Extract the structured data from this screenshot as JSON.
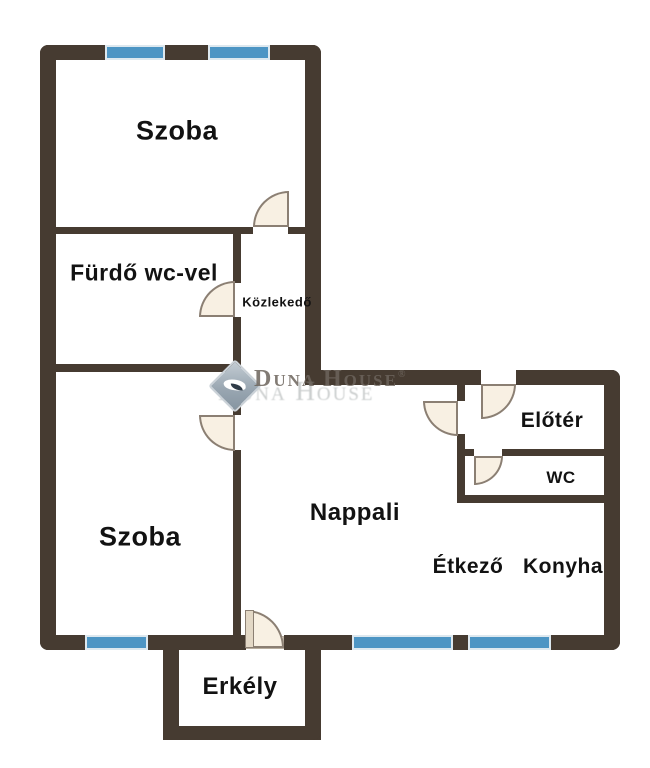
{
  "colors": {
    "wall": "#463B31",
    "window_glass": "#4D95C4",
    "window_frame": "#DDE8EF",
    "door_fill": "#F8F0E3",
    "door_stroke": "#8B7F73",
    "label_text": "#121212",
    "watermark_text": "#6C645C",
    "watermark_logo": "#9AA7B2"
  },
  "rooms": [
    {
      "id": "szoba-felso",
      "label": "Szoba"
    },
    {
      "id": "furdo",
      "label": "Fürdő wc-vel"
    },
    {
      "id": "kozlekedo",
      "label": "Közlekedő"
    },
    {
      "id": "szoba-also",
      "label": "Szoba"
    },
    {
      "id": "nappali",
      "label": "Nappali"
    },
    {
      "id": "etkezo",
      "label": "Étkező"
    },
    {
      "id": "konyha",
      "label": "Konyha"
    },
    {
      "id": "eloter",
      "label": "Előtér"
    },
    {
      "id": "wc",
      "label": "WC"
    },
    {
      "id": "erkely",
      "label": "Erkély"
    }
  ],
  "watermark": {
    "word1": "Duna",
    "word2": "House",
    "registered_mark": "®",
    "ghost_text": "Duna House",
    "logo": "duna-house-diamond-logo"
  }
}
